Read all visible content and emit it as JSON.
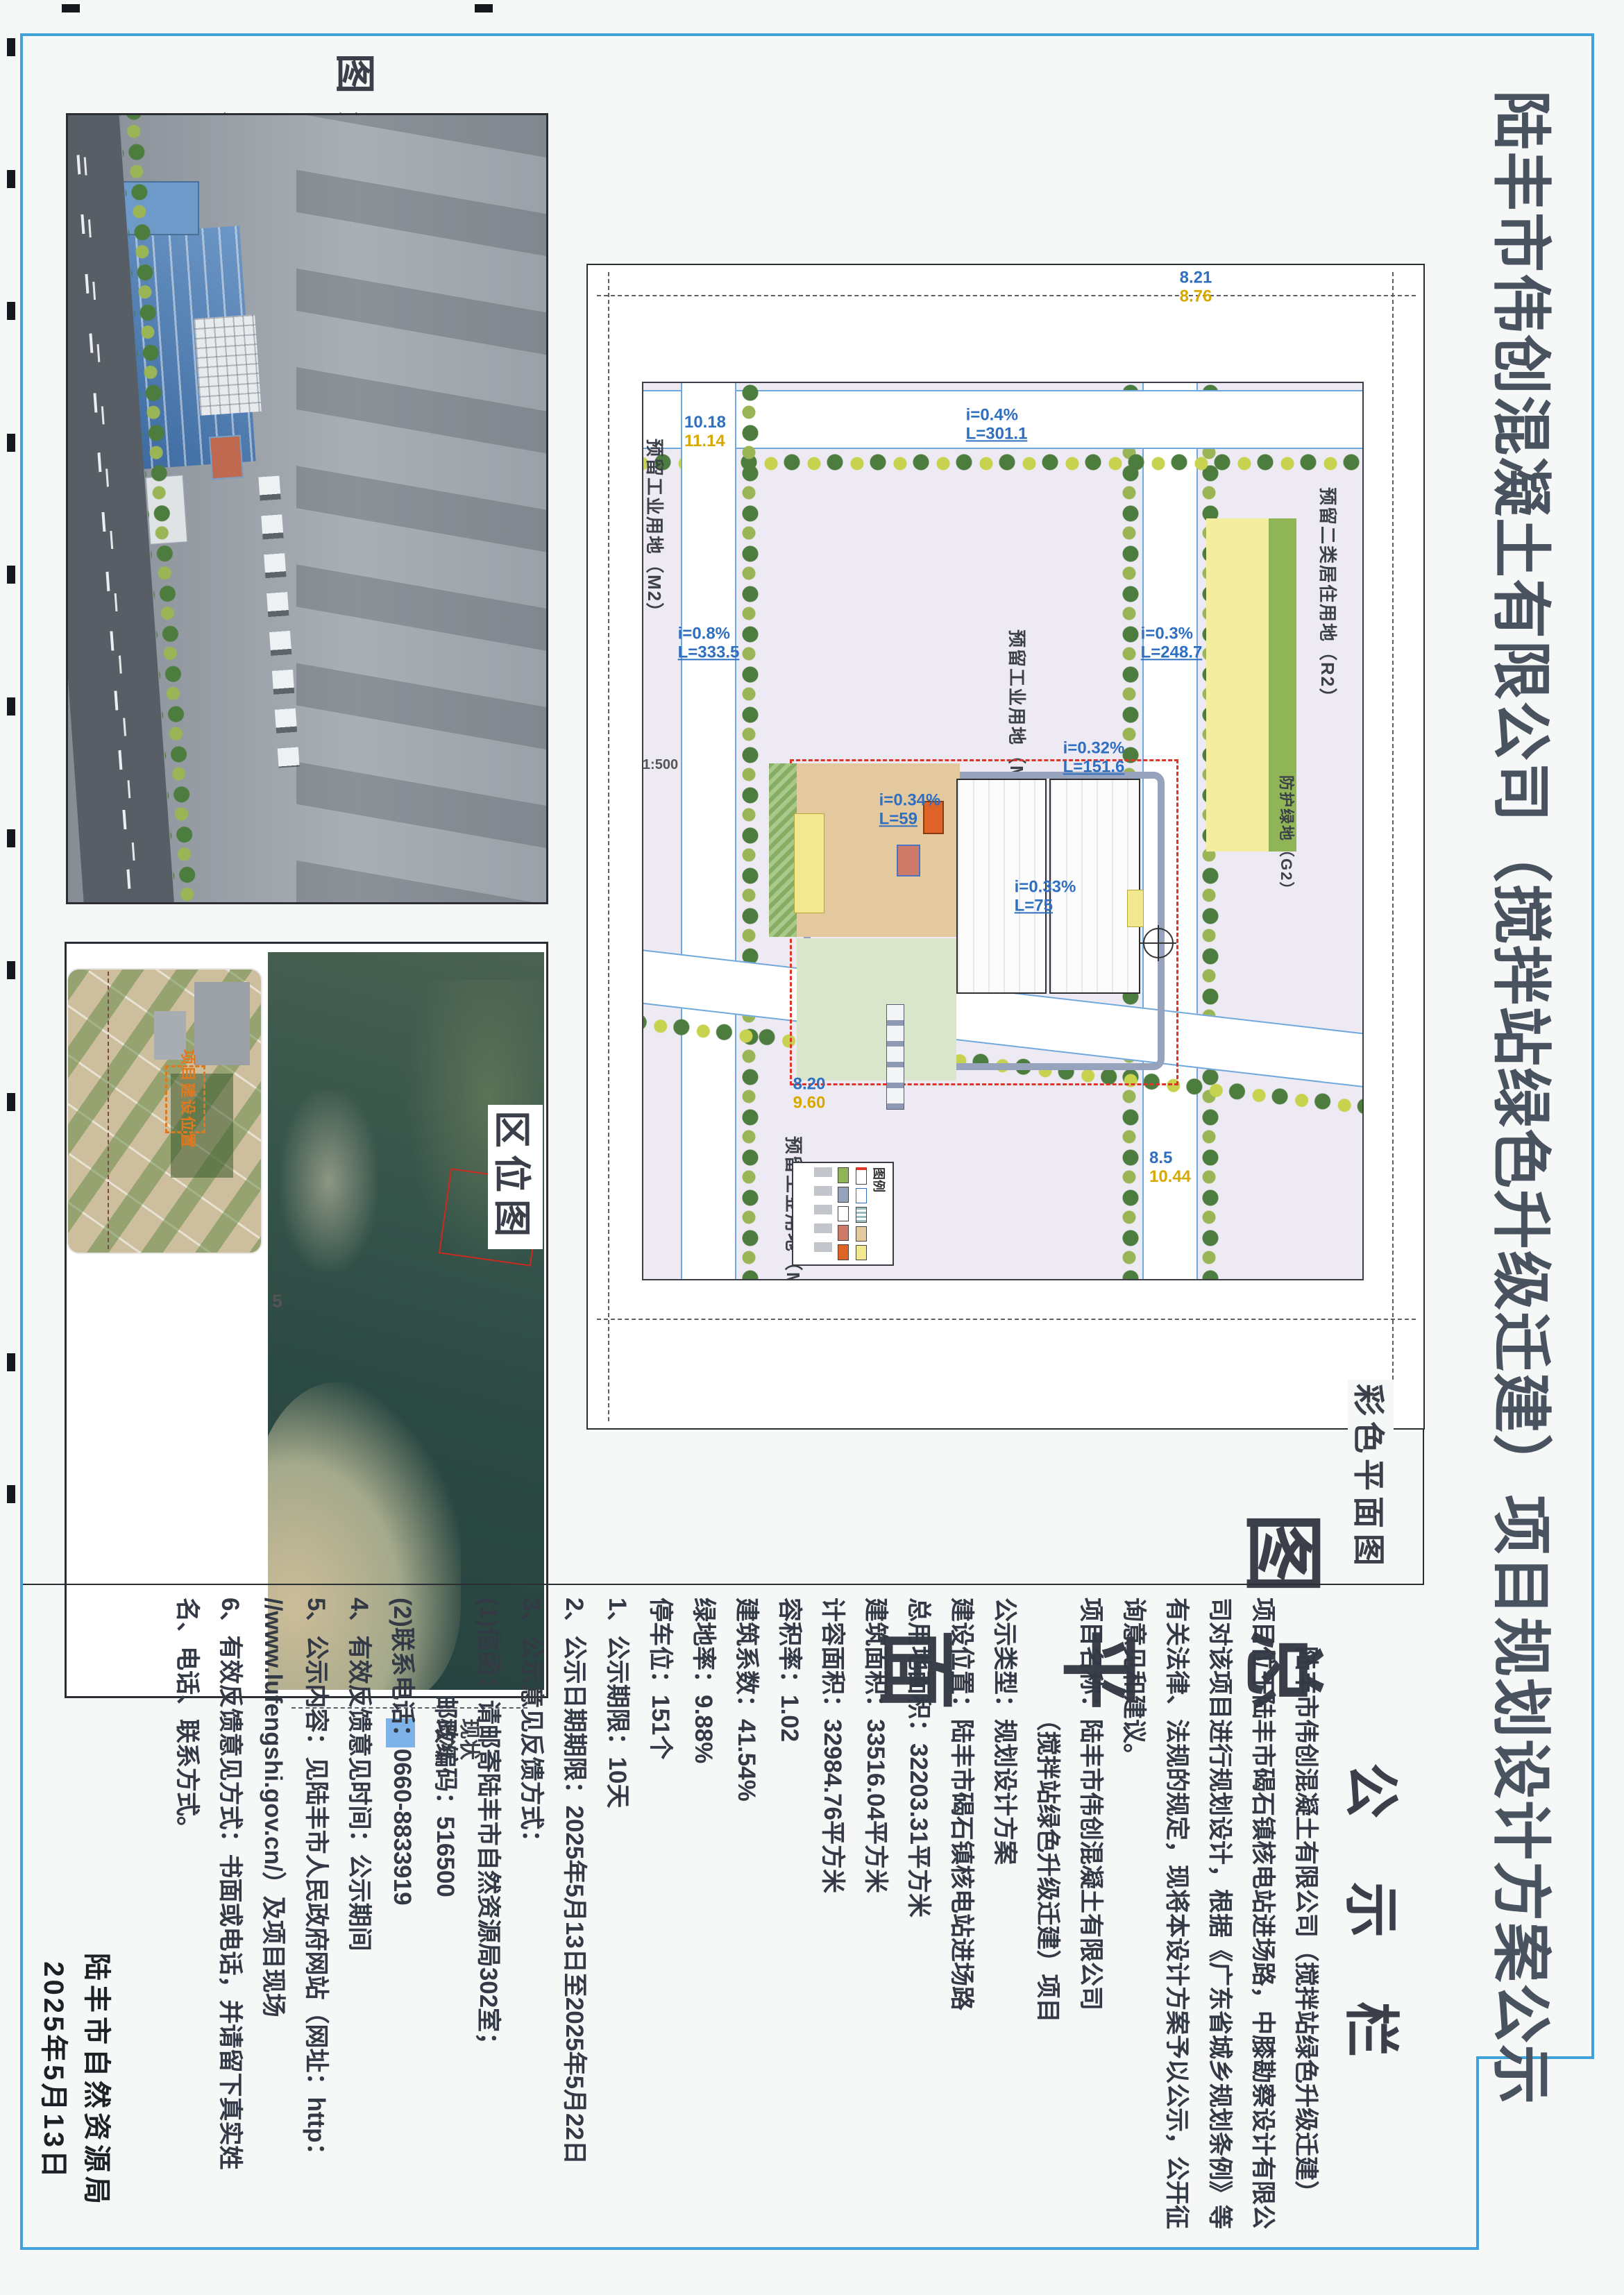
{
  "document": {
    "title": "陆丰市伟创混凝土有限公司（搅拌站绿色升级迁建）项目规划设计方案公示",
    "page_mark": "5"
  },
  "panels": {
    "render": {
      "label": "效果图"
    },
    "location": {
      "label": "区位图",
      "marker_label": "项目建设位置",
      "status_label_line1": "现状",
      "status_label_line2": "概况"
    },
    "site_plan": {
      "caption_main": "总平面图",
      "caption_color": "彩色平面图",
      "scale_note": "1:500",
      "legend_title": "图例",
      "land_use_labels": {
        "m2a": "预留工业用地（M2）",
        "m2b": "预留工业用地（M2）",
        "m2c": "预留工业用地（M2）",
        "r2": "预留二类居住用地（R2）",
        "g2": "防护绿地（G2）"
      },
      "road_labels": {
        "a1": "i=0.4%",
        "a2": "L=301.1",
        "b1": "i=0.8%",
        "b2": "L=333.5",
        "c1": "i=0.3%",
        "c2": "L=248.7",
        "d1": "i=0.32%",
        "d2": "L=151.6",
        "e1": "i=0.34%",
        "e2": "L=59",
        "f1": "i=0.33%",
        "f2": "L=75"
      },
      "elevations": {
        "p1a": "8.20",
        "p1b": "9.60",
        "p2a": "8.5",
        "p2b": "10.44",
        "p3a": "10.18",
        "p3b": "11.14",
        "p4a": "8.21",
        "p4b": "8.76"
      }
    }
  },
  "notice": {
    "heading": "公 示 栏",
    "lines": [
      "　　陆丰市伟创混凝土有限公司（搅拌站绿色升级迁建）",
      "项目位于陆丰市碣石镇核电站进场路，中膝勘察设计有限公",
      "司对该项目进行规划设计，根据《广东省城乡规划条例》等",
      "有关法律、法规的规定，现将本设计方案予以公示，公开征",
      "询意见和建议。",
      "项目名称：陆丰市伟创混凝土有限公司",
      "　　　　　（搅拌站绿色升级迁建）项目",
      "公示类型：规划设计方案",
      "建设位置：陆丰市碣石镇核电站进场路",
      "总用地面积：32203.31平方米",
      "建筑面积：33516.04平方米",
      "计容面积：32984.76平方米",
      "容积率：1.02",
      "建筑系数：41.54%",
      "绿地率：9.88%",
      "停车位：151个",
      "1、公示期限：10天",
      "2、公示日期期限：2025年5月13日至2025年5月22日",
      "3、公示意见反馈方式：",
      "(1)信函：请邮寄陆丰市自然资源局302室；",
      "　　　　邮政编码：516500",
      "(2)联系电话：0660-8833919",
      "4、有效反馈意见时间：公示期间",
      "5、公示内容：见陆丰市人民政府网站（网址：http：",
      "//www.lufengshi.gov.cn/）及项目现场",
      "6、有效反馈意见方式：书面或电话，并请留下真实姓",
      "名、电话、联系方式。"
    ],
    "signature": "陆丰市自然资源局",
    "signature_date": "2025年5月13日"
  },
  "colors": {
    "frame_blue": "#3fa3da",
    "ink": "#49525f",
    "plan_field": "#eeeaf4",
    "road_edge": "#6fa8dc",
    "boundary_red": "#df3428",
    "protect_green_yellow": "#f3eda0",
    "orange_building": "#dd6327",
    "marker_orange": "#e07820"
  }
}
